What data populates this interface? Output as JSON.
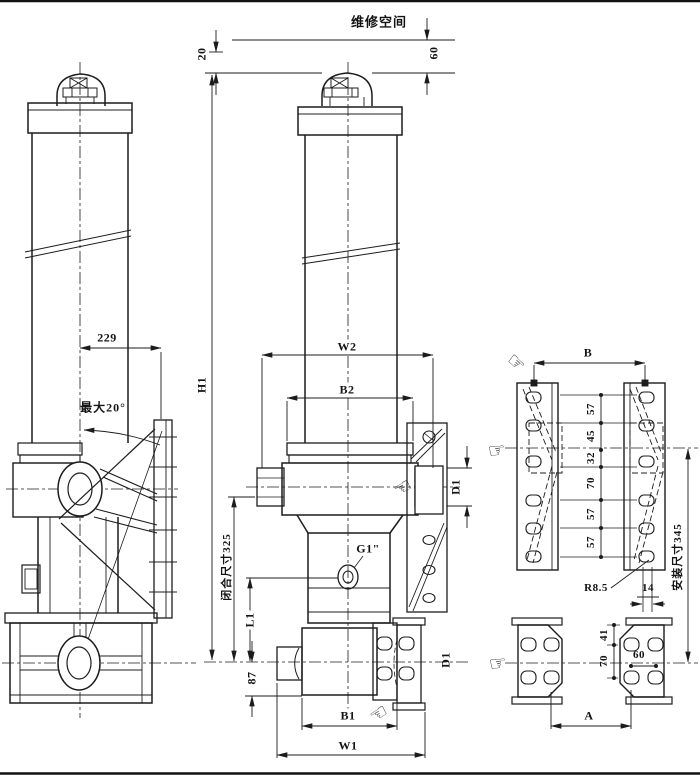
{
  "drawing": {
    "type": "engineering-drawing",
    "subject": "telescopic hydraulic cylinder with mounting plates"
  },
  "labels": {
    "maintenance_space": "维修空间",
    "clearance60": "60",
    "gap20": "20",
    "offset229": "229",
    "max_angle": "最大20°",
    "h1": "H1",
    "w2": "W2",
    "b2": "B2",
    "d1_pin": "D1",
    "closed_length": "闭合尺寸325",
    "port": "G1\"",
    "l1": "L1",
    "dim87": "87",
    "b1": "B1",
    "w1": "W1",
    "d1_hole": "D1",
    "b": "B",
    "chain": [
      "57",
      "45",
      "32",
      "70",
      "57",
      "57"
    ],
    "install_length": "安装尺寸345",
    "slot_r": "R8.5",
    "slot_w": "14",
    "p41": "41",
    "p70": "70",
    "p60": "60",
    "a": "A"
  },
  "icons": {
    "pointer_right": "☞",
    "pointer_left": "☜"
  },
  "colors": {
    "line": "#1c1c1c",
    "bg": "#ffffff"
  }
}
